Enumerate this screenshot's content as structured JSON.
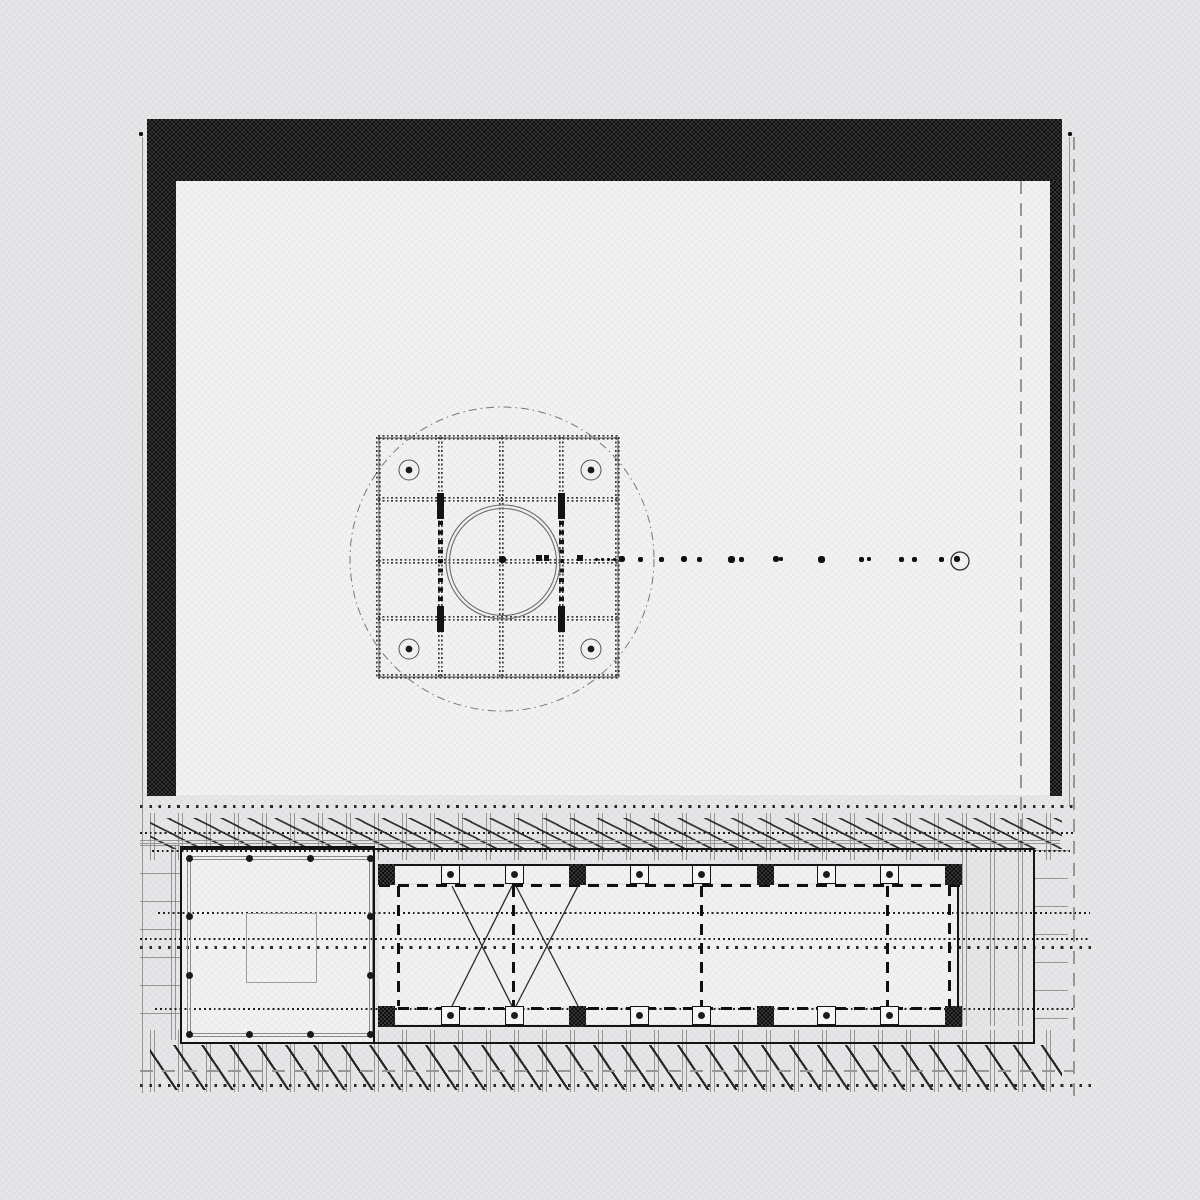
{
  "palette": {
    "page_bg": "#ebebed",
    "paper": "#f7f7f8",
    "ink": "#141414",
    "wall_black": "#161616",
    "gray_line": "#9a9a9a",
    "grid_dot": "#3c3c3c",
    "dash_gray": "#9b9b9b",
    "brace": "#2e2e2e",
    "circle_gray": "#7a7a7a",
    "bolt_ring": "#555555"
  },
  "upper": {
    "paper": {
      "x": 176,
      "y": 181,
      "w": 874,
      "h": 614
    },
    "walls": [
      {
        "name": "wall-band-top",
        "x": 147,
        "y": 119,
        "w": 915,
        "h": 62
      },
      {
        "name": "wall-band-left",
        "x": 147,
        "y": 119,
        "w": 29,
        "h": 677
      },
      {
        "name": "wall-band-right",
        "x": 1050,
        "y": 181,
        "w": 12,
        "h": 615
      }
    ],
    "boundary_lines": [
      {
        "name": "boundary-line-left",
        "x": 142,
        "y": 137,
        "h": 956
      },
      {
        "name": "boundary-line-right",
        "x": 1069,
        "y": 137,
        "h": 670
      }
    ],
    "dash_lines": [
      {
        "name": "survey-dash-line-right",
        "x": 1073,
        "y": 137,
        "h": 959
      },
      {
        "name": "survey-dash-line-inner",
        "x": 1020,
        "y": 181,
        "h": 667
      }
    ],
    "ref_dots": [
      {
        "x": 139,
        "y": 132
      },
      {
        "x": 1068,
        "y": 132
      }
    ],
    "square": {
      "x": 378,
      "y": 437,
      "s": 241
    },
    "grid_xs": [
      378.5,
      440,
      501,
      561,
      617.5
    ],
    "grid_ys": [
      437.5,
      499,
      561,
      618,
      676.5
    ],
    "big_circle": {
      "cx": 502,
      "cy": 559,
      "r": 152
    },
    "pipe_circles": [
      {
        "cx": 503,
        "cy": 562,
        "r": 57
      },
      {
        "cx": 503,
        "cy": 562,
        "r": 53.5
      }
    ],
    "bolts": [
      {
        "x": 409,
        "y": 470
      },
      {
        "x": 591,
        "y": 470
      },
      {
        "x": 409,
        "y": 649
      },
      {
        "x": 591,
        "y": 649
      }
    ],
    "heavy_bars": [
      {
        "x": 437,
        "y": 493,
        "w": 7,
        "h": 26
      },
      {
        "x": 437,
        "y": 606,
        "w": 7,
        "h": 26
      },
      {
        "x": 558,
        "y": 493,
        "w": 7,
        "h": 26
      },
      {
        "x": 558,
        "y": 606,
        "w": 7,
        "h": 26
      }
    ],
    "heavy_dot_strips": [
      {
        "x": 438,
        "y": 521,
        "w": 4.5,
        "h": 83
      },
      {
        "x": 559,
        "y": 521,
        "w": 4.5,
        "h": 83
      }
    ],
    "axis_marks": [
      {
        "x": 536,
        "y": 555,
        "w": 6,
        "h": 6
      },
      {
        "x": 544,
        "y": 555,
        "w": 5,
        "h": 6
      },
      {
        "x": 577,
        "y": 555,
        "w": 6,
        "h": 6
      }
    ],
    "center_dot": {
      "x": 499,
      "y": 556,
      "s": 7
    },
    "axis_y": 559,
    "axis_dots": [
      [
        596,
        3
      ],
      [
        602,
        3
      ],
      [
        608,
        3
      ],
      [
        614,
        3
      ],
      [
        622,
        6
      ],
      [
        640,
        5
      ],
      [
        661,
        5
      ],
      [
        684,
        6
      ],
      [
        699,
        5
      ],
      [
        731,
        7
      ],
      [
        741,
        5
      ],
      [
        776,
        6
      ],
      [
        781,
        4
      ],
      [
        821,
        7
      ],
      [
        861,
        5
      ],
      [
        869,
        4
      ],
      [
        901,
        5
      ],
      [
        914,
        5
      ],
      [
        941,
        5
      ],
      [
        957,
        6
      ]
    ],
    "end_circle": {
      "cx": 960,
      "cy": 561,
      "r": 9
    }
  },
  "lower": {
    "ladders": [
      {
        "name": "ladder-left",
        "x": 140,
        "y": 845,
        "w": 40,
        "h": 196
      },
      {
        "name": "ladder-right",
        "x": 1035,
        "y": 850,
        "w": 33,
        "h": 196
      }
    ],
    "tick_strips": [
      {
        "x": 150,
        "y": 813,
        "w": 915,
        "h": 47
      },
      {
        "x": 150,
        "y": 1030,
        "w": 915,
        "h": 62
      },
      {
        "x": 962,
        "y": 860,
        "w": 73,
        "h": 166
      },
      {
        "x": 171,
        "y": 845,
        "w": 9,
        "h": 195
      }
    ],
    "hatch_top": {
      "x": 150,
      "y": 818,
      "w": 912,
      "h": 31
    },
    "hatch_bottom": {
      "x": 150,
      "y": 1045,
      "w": 912,
      "h": 45
    },
    "gray_lines": [
      {
        "y": 840,
        "x": 140,
        "w": 920
      },
      {
        "y": 843,
        "x": 140,
        "w": 920
      }
    ],
    "gray_dash": {
      "y": 1070,
      "x": 140,
      "w": 933
    },
    "dot_rows": [
      {
        "y": 806,
        "x": 140,
        "w": 933,
        "k": "sparse"
      },
      {
        "y": 833,
        "x": 140,
        "w": 933,
        "k": "dense"
      },
      {
        "y": 851,
        "x": 152,
        "w": 921,
        "k": "dense"
      },
      {
        "y": 913,
        "x": 158,
        "w": 932,
        "k": "dense"
      },
      {
        "y": 939,
        "x": 140,
        "w": 950,
        "k": "dense"
      },
      {
        "y": 947,
        "x": 140,
        "w": 956,
        "k": "sparse"
      },
      {
        "y": 1009,
        "x": 155,
        "w": 918,
        "k": "dense"
      },
      {
        "y": 1085,
        "x": 140,
        "w": 956,
        "k": "sparse"
      }
    ],
    "site_rect": {
      "x": 180,
      "y": 848,
      "w": 855,
      "h": 196
    },
    "pavilion": {
      "outer": {
        "x": 180,
        "y": 846,
        "w": 195,
        "h": 198
      },
      "inner": {
        "x": 187,
        "y": 856,
        "w": 186,
        "h": 181
      },
      "plinth": {
        "x": 246,
        "y": 913,
        "w": 71,
        "h": 70
      },
      "dot_xs": [
        189,
        249,
        310,
        370
      ],
      "top_y": 858,
      "bot_y": 1034,
      "side_dot_ys": [
        916,
        975
      ],
      "side_xs": [
        189,
        370
      ]
    },
    "hall": {
      "x1": 379,
      "x2": 962,
      "floor": {
        "x": 379,
        "y": 885,
        "w": 578,
        "h": 122
      },
      "top": {
        "solid_y": 864,
        "band_y": 866,
        "band_h": 17,
        "dash_y": 884
      },
      "bottom": {
        "dash_y": 1007,
        "band_y": 1009,
        "band_h": 15,
        "solid_y": 1025
      },
      "right_solid_x": 957,
      "right_dash": {
        "x": 948,
        "y": 866,
        "h": 159
      },
      "inner_dash_xs": [
        397,
        512,
        700,
        886
      ],
      "inner_dash_y": 886,
      "inner_dash_h": 120,
      "col_xs": [
        450,
        514,
        639,
        701,
        826,
        889
      ],
      "block_xs": [
        386,
        577,
        765,
        953
      ],
      "col_top_y": 865,
      "col_bot_y": 1006,
      "block_top_y": 864,
      "block_bot_y": 1006,
      "braces": [
        [
          452,
          886,
          512,
          1006
        ],
        [
          512,
          886,
          452,
          1006
        ],
        [
          516,
          886,
          578,
          1006
        ],
        [
          578,
          886,
          516,
          1006
        ]
      ]
    }
  }
}
